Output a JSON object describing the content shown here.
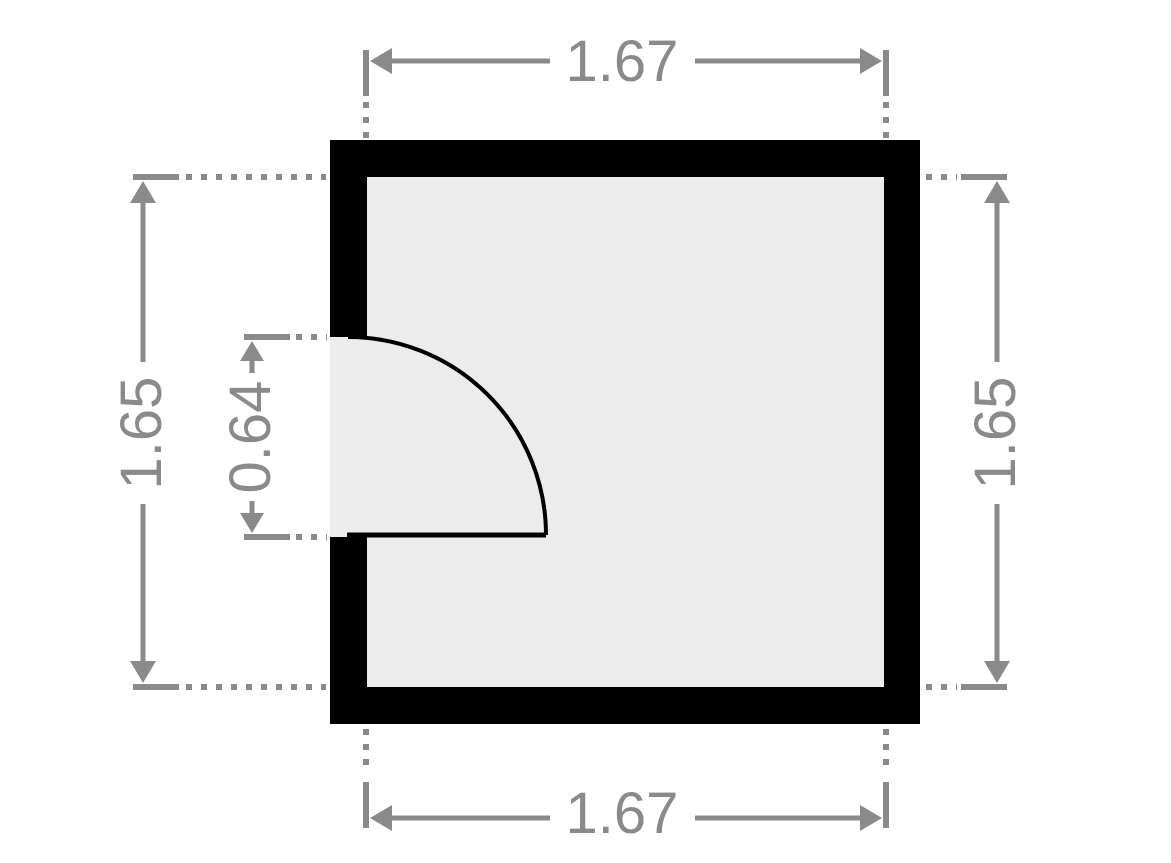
{
  "floor_plan": {
    "type": "room-with-door",
    "dimensions": {
      "top_width": "1.67",
      "bottom_width": "1.67",
      "left_height": "1.65",
      "right_height": "1.65",
      "door_opening": "0.64"
    },
    "door": {
      "wall_side": "left",
      "swing": "quarter-circle-into-room"
    }
  },
  "colors": {
    "wall": "#000000",
    "floor": "#ececec",
    "dimension": "#8a8a8a",
    "background": "#ffffff"
  }
}
